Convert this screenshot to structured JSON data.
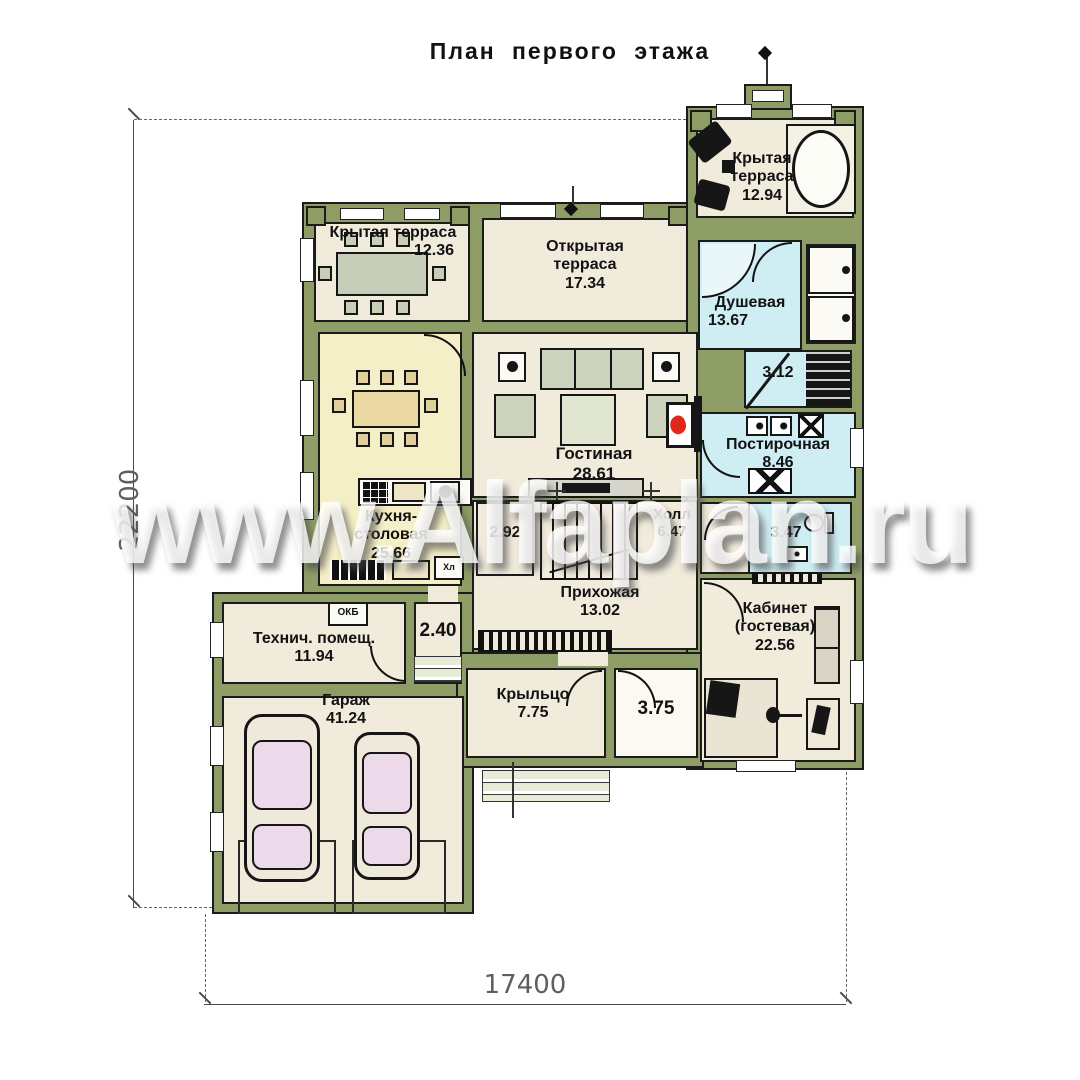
{
  "title": "План первого этажа",
  "watermark": "www.Alfaplan.ru",
  "dimensions": {
    "left": "22200",
    "bottom": "17400"
  },
  "rooms": {
    "terrace_left": {
      "name": "Крытая терраса",
      "area": "12.36"
    },
    "terrace_open": {
      "name": "Открытая терраса",
      "area": "17.34"
    },
    "terrace_right": {
      "name": "Крытая терраса",
      "area": "12.94"
    },
    "shower": {
      "name": "Душевая",
      "area": "13.67"
    },
    "sauna": {
      "area": "3.12"
    },
    "living": {
      "name": "Гостиная",
      "area": "28.61"
    },
    "kitchen": {
      "name": "Кухня-столовая",
      "area": "25.66"
    },
    "laundry": {
      "name": "Постирочная",
      "area": "8.46"
    },
    "hall": {
      "name": "Холл",
      "area": "6.47"
    },
    "pantry": {
      "area": "2.92"
    },
    "wc": {
      "area": "3.47"
    },
    "entry": {
      "name": "Прихожая",
      "area": "13.02"
    },
    "office": {
      "name": "Кабинет (гостевая)",
      "area": "22.56"
    },
    "tech": {
      "name": "Технич. помещ.",
      "area": "11.94"
    },
    "stair_hall": {
      "area": "2.40"
    },
    "garage": {
      "name": "Гараж",
      "area": "41.24"
    },
    "porch": {
      "name": "Крыльцо",
      "area": "7.75"
    },
    "vestibule": {
      "area": "3.75"
    }
  },
  "labels": {
    "fridge": "Хл",
    "boiler": "ОКБ"
  },
  "colors": {
    "wall": "#8e9c66",
    "cream": "#f1ebdc",
    "kitchen": "#f5efc7",
    "wet": "#cfeef4",
    "flame": "#e02718",
    "ink": "#1b1b1b",
    "paper": "#ffffff"
  }
}
